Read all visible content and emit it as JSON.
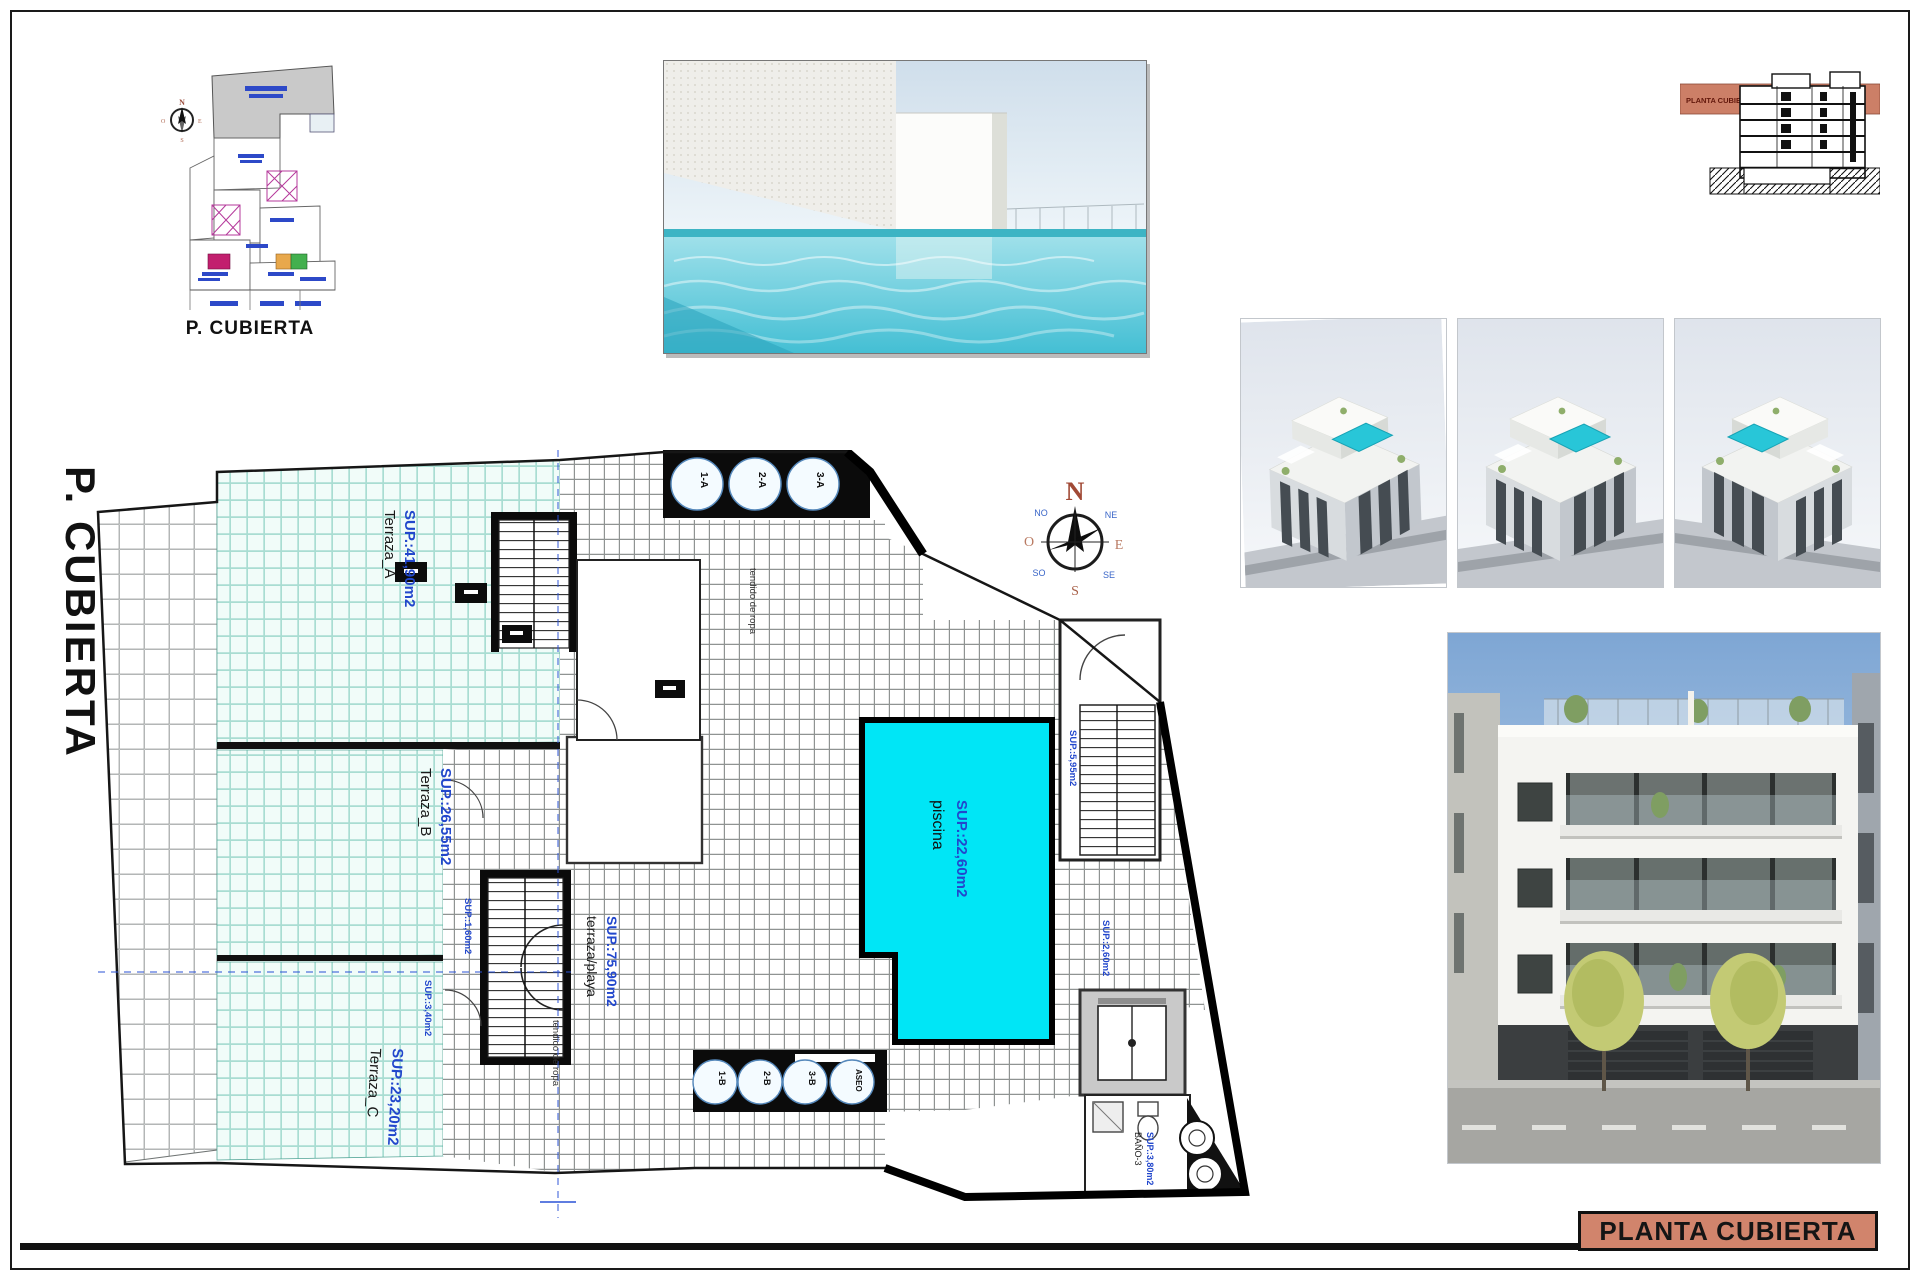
{
  "sheet": {
    "side_title": "P. CUBIERTA",
    "title_block_label": "PLANTA CUBIERTA"
  },
  "key_plan": {
    "caption": "P. CUBIERTA"
  },
  "section_thumbnail": {
    "band_label": "PLANTA CUBIERTA"
  },
  "compass": {
    "n": "N",
    "e": "E",
    "s": "S",
    "o": "O",
    "ne": "NE",
    "no": "NO",
    "se": "SE",
    "so": "SO"
  },
  "floor_plan": {
    "terraces": [
      {
        "name": "Terraza_A",
        "area": "SUP.:41,90m2"
      },
      {
        "name": "Terraza_B",
        "area": "SUP.:26,55m2"
      },
      {
        "name": "Terraza_C",
        "area": "SUP.:23,20m2"
      }
    ],
    "beach_terrace": {
      "name": "terraza/playa",
      "area": "SUP.:75,90m2"
    },
    "pool": {
      "name": "piscina",
      "area": "SUP.:22,60m2"
    },
    "bath": {
      "name": "BAÑO-3",
      "area": "SUP.:3,80m2"
    },
    "clothesline_1": "tendido de ropa",
    "clothesline_2": "tendido de ropa",
    "stair_area_1": "SUP.:1,60m2",
    "stair_area_2": "SUP.:3,40m2",
    "stair_area_3": "SUP.:2,60m2",
    "stair_area_4": "SUP.:5,95m2",
    "skylights_top": [
      "1-A",
      "2-A",
      "3-A"
    ],
    "skylights_bottom": [
      "1-B",
      "2-B",
      "3-B",
      "ASEO"
    ]
  },
  "colors": {
    "pool": "#00e6f6",
    "terrace_tile": "#f1fcf9",
    "salmon": "#d1846c",
    "label_blue": "#2247cc"
  }
}
